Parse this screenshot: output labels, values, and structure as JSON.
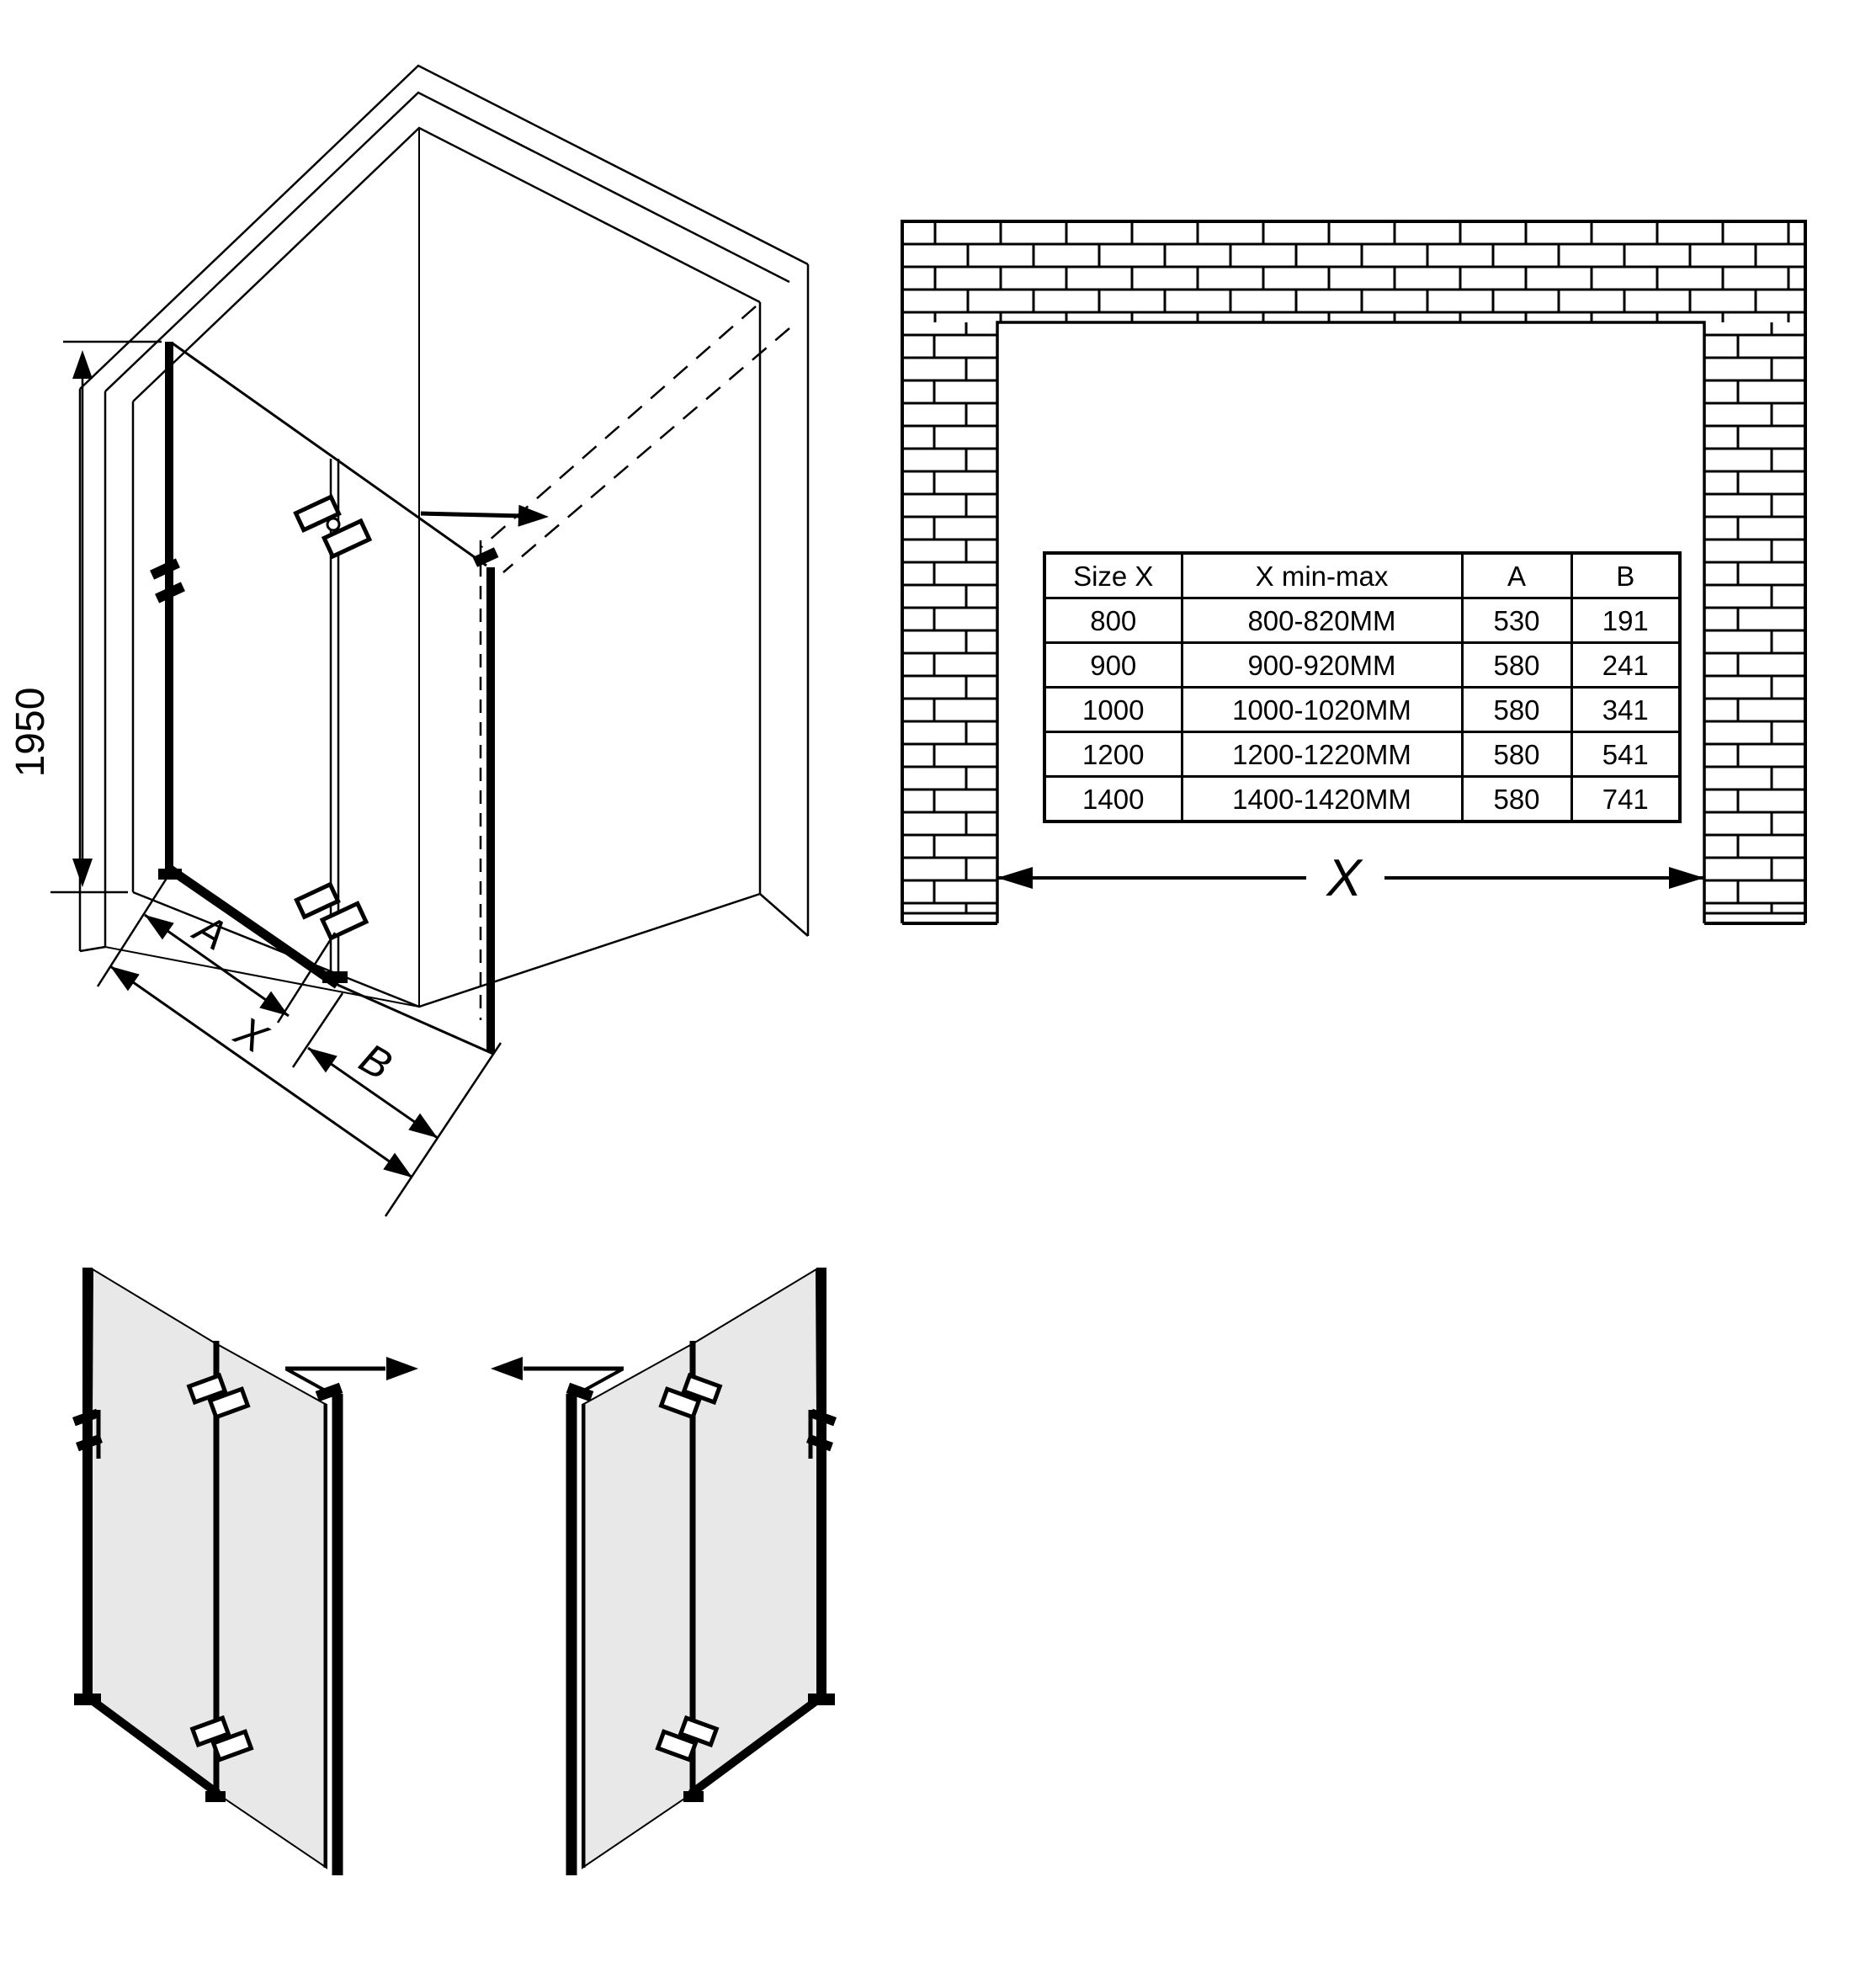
{
  "isometric_view": {
    "height_dimension": "1950",
    "dim_door_panel": "A",
    "dim_total_width": "X",
    "dim_fixed_panel": "B"
  },
  "wall_opening_view": {
    "width_dimension_label": "X"
  },
  "size_table": {
    "headers": [
      "Size X",
      "X min-max",
      "A",
      "B"
    ],
    "rows": [
      [
        "800",
        "800-820MM",
        "530",
        "191"
      ],
      [
        "900",
        "900-920MM",
        "580",
        "241"
      ],
      [
        "1000",
        "1000-1020MM",
        "580",
        "341"
      ],
      [
        "1200",
        "1200-1220MM",
        "580",
        "541"
      ],
      [
        "1400",
        "1400-1420MM",
        "580",
        "741"
      ]
    ]
  },
  "icons": {
    "swing_direction": "arrow-right-icon",
    "width_measure": "double-arrow-icon"
  },
  "colors": {
    "line_color": "#000000",
    "glass_color": "#e8e8e8",
    "background": "#ffffff"
  }
}
